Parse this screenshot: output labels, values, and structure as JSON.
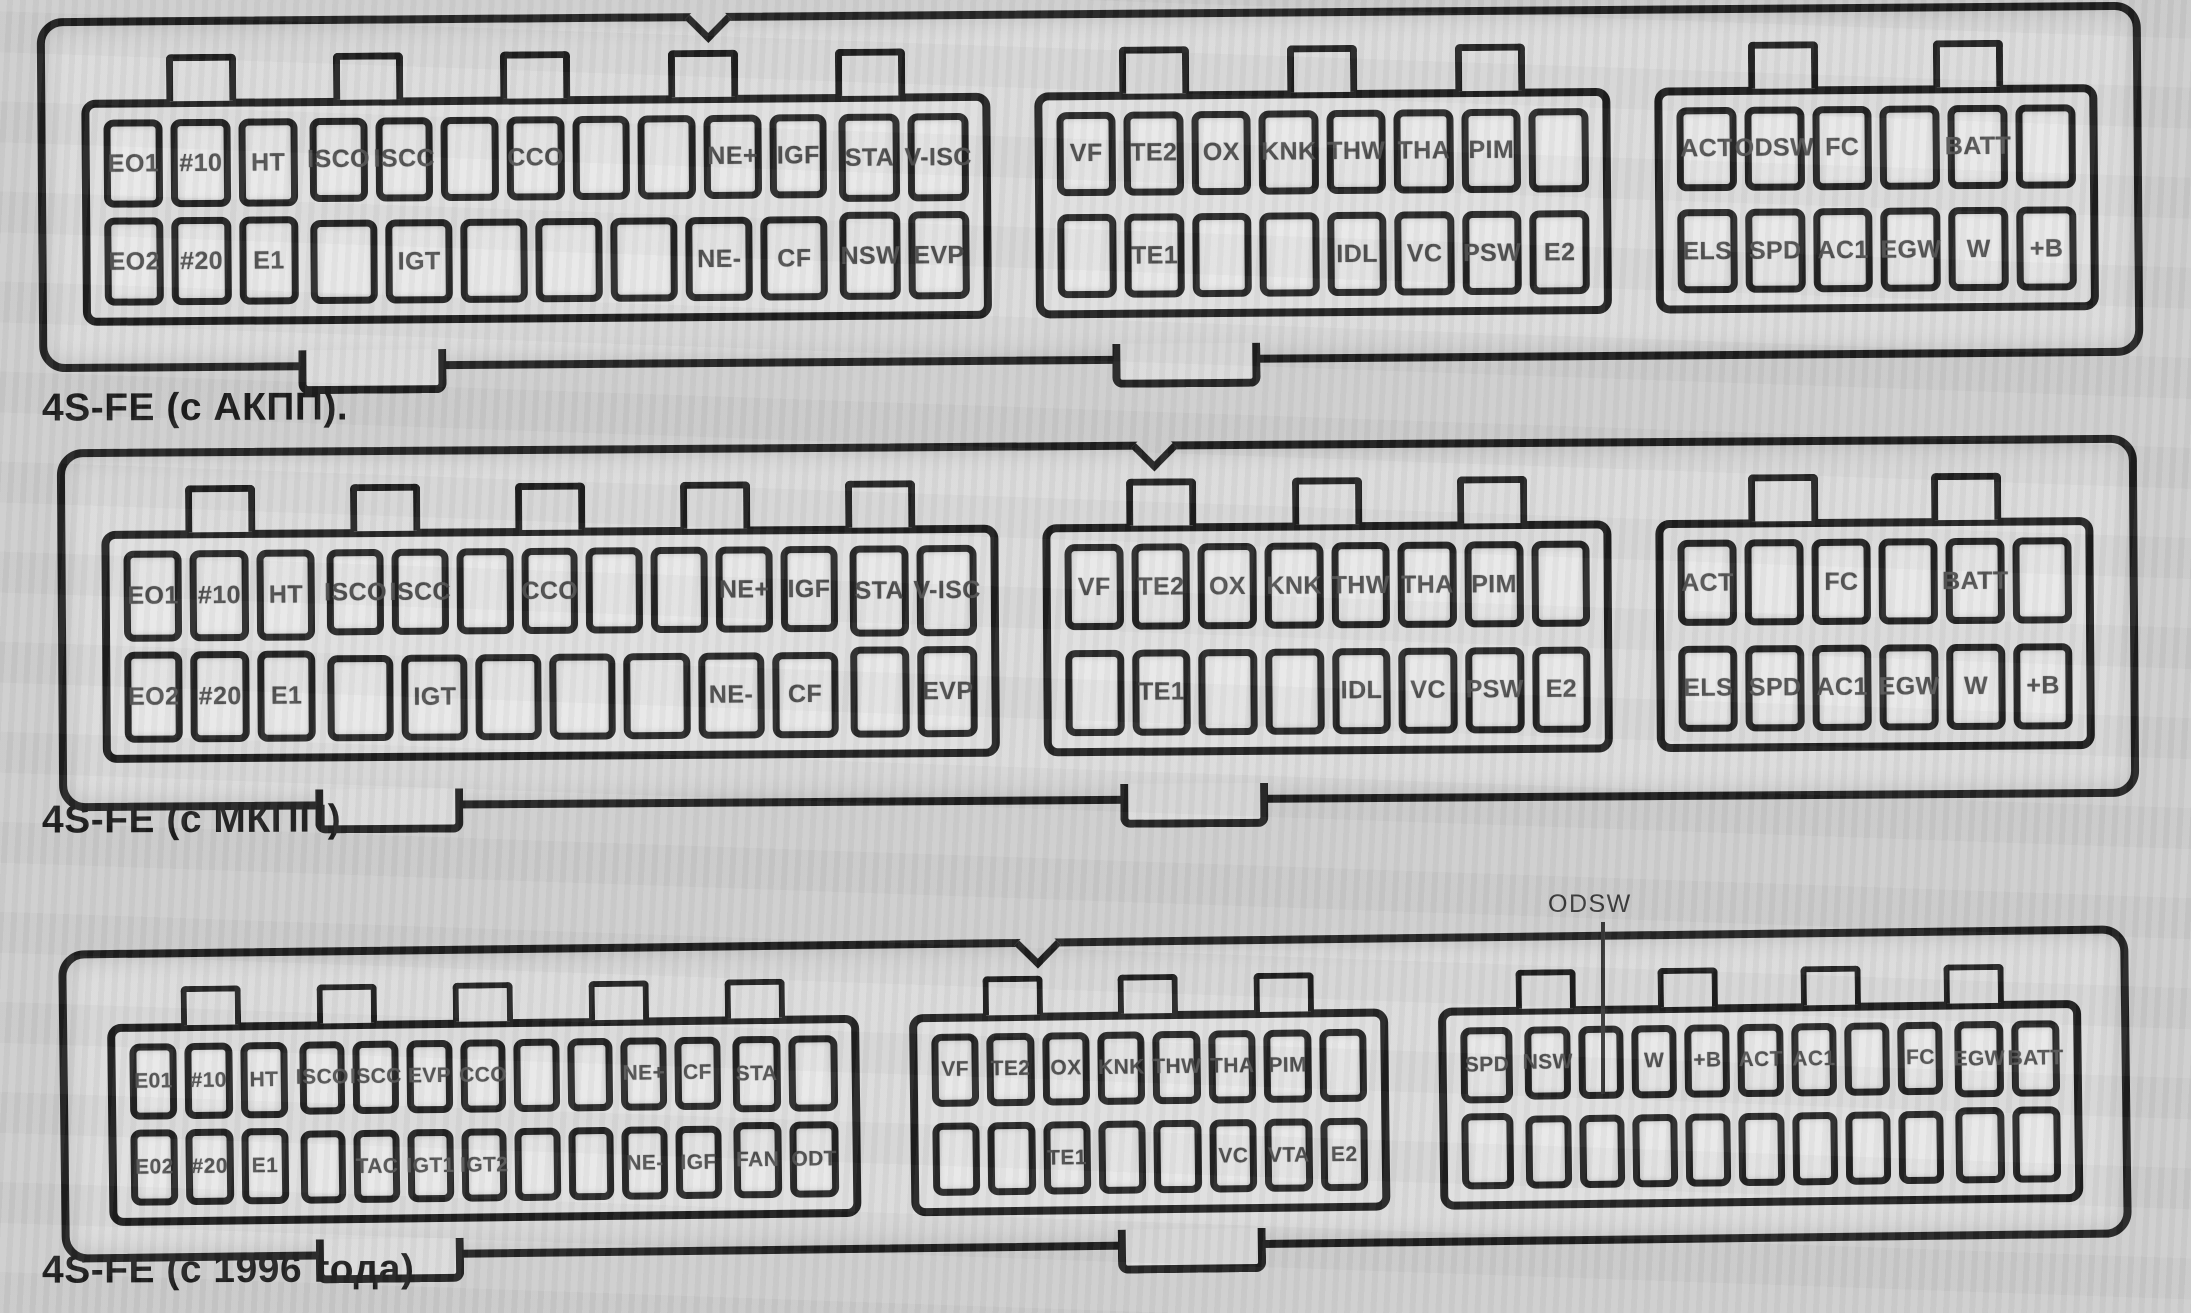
{
  "colors": {
    "ink": "#171717",
    "paper": "#cdcdcd",
    "housing": "#dadada",
    "cell": "#e8e8e8",
    "pin_label": "#4a4a4a"
  },
  "diagrams": [
    {
      "caption": "4S-FE (с АКПП).",
      "connectors": [
        {
          "name": "left",
          "sections": [
            {
              "type": "cols",
              "cols": [
                [
                  "EO1",
                  "EO2"
                ],
                [
                  "#10",
                  "#20"
                ],
                [
                  "HT",
                  "E1"
                ]
              ]
            },
            {
              "type": "rows",
              "top": [
                "ISCO",
                "ISCC",
                "",
                "CCO",
                "",
                "",
                "NE+",
                "IGF"
              ],
              "bottom": [
                "",
                "IGT",
                "",
                "",
                "",
                "NE-",
                "CF"
              ]
            },
            {
              "type": "cols",
              "cols": [
                [
                  "STA",
                  "NSW"
                ],
                [
                  "V-ISC",
                  "EVP"
                ]
              ]
            }
          ]
        },
        {
          "name": "middle",
          "sections": [
            {
              "type": "rows",
              "top": [
                "VF",
                "TE2",
                "OX",
                "KNK",
                "THW",
                "THA",
                "PIM",
                ""
              ],
              "bottom": [
                "",
                "TE1",
                "",
                "",
                "IDL",
                "VC",
                "PSW",
                "E2"
              ]
            }
          ]
        },
        {
          "name": "right",
          "sections": [
            {
              "type": "rows",
              "top": [
                "ACT",
                "ODSW",
                "FC",
                "",
                "BATT",
                ""
              ],
              "bottom": [
                "ELS",
                "SPD",
                "AC1",
                "EGW",
                "W",
                "+B"
              ]
            }
          ]
        }
      ]
    },
    {
      "caption": "4S-FE (с МКПП).",
      "connectors": [
        {
          "name": "left",
          "sections": [
            {
              "type": "cols",
              "cols": [
                [
                  "EO1",
                  "EO2"
                ],
                [
                  "#10",
                  "#20"
                ],
                [
                  "HT",
                  "E1"
                ]
              ]
            },
            {
              "type": "rows",
              "top": [
                "ISCO",
                "ISCC",
                "",
                "CCO",
                "",
                "",
                "NE+",
                "IGF"
              ],
              "bottom": [
                "",
                "IGT",
                "",
                "",
                "",
                "NE-",
                "CF"
              ]
            },
            {
              "type": "cols",
              "cols": [
                [
                  "STA",
                  ""
                ],
                [
                  "V-ISC",
                  "EVP"
                ]
              ]
            }
          ]
        },
        {
          "name": "middle",
          "sections": [
            {
              "type": "rows",
              "top": [
                "VF",
                "TE2",
                "OX",
                "KNK",
                "THW",
                "THA",
                "PIM",
                ""
              ],
              "bottom": [
                "",
                "TE1",
                "",
                "",
                "IDL",
                "VC",
                "PSW",
                "E2"
              ]
            }
          ]
        },
        {
          "name": "right",
          "sections": [
            {
              "type": "rows",
              "top": [
                "ACT",
                "",
                "FC",
                "",
                "BATT",
                ""
              ],
              "bottom": [
                "ELS",
                "SPD",
                "AC1",
                "EGW",
                "W",
                "+B"
              ]
            }
          ]
        }
      ]
    },
    {
      "caption": "4S-FE (с 1996 года).",
      "callout_label": "ODSW",
      "connectors": [
        {
          "name": "left",
          "sections": [
            {
              "type": "cols",
              "cols": [
                [
                  "E01",
                  "E02"
                ],
                [
                  "#10",
                  "#20"
                ],
                [
                  "HT",
                  "E1"
                ]
              ]
            },
            {
              "type": "rows",
              "top": [
                "ISCO",
                "ISCC",
                "EVP",
                "CCO",
                "",
                "",
                "NE+",
                "CF"
              ],
              "bottom": [
                "",
                "TAC",
                "IGT1",
                "IGT2",
                "",
                "",
                "NE-",
                "IGF"
              ]
            },
            {
              "type": "cols",
              "cols": [
                [
                  "STA",
                  "FAN"
                ],
                [
                  "",
                  "ODT"
                ]
              ]
            }
          ]
        },
        {
          "name": "middle",
          "sections": [
            {
              "type": "rows",
              "top": [
                "VF",
                "TE2",
                "OX",
                "KNK",
                "THW",
                "THA",
                "PIM",
                ""
              ],
              "bottom": [
                "",
                "",
                "TE1",
                "",
                "",
                "VC",
                "VTA",
                "E2"
              ]
            }
          ]
        },
        {
          "name": "right",
          "sections": [
            {
              "type": "cols",
              "cols": [
                [
                  "SPD",
                  ""
                ]
              ]
            },
            {
              "type": "rows",
              "top": [
                "NSW",
                "",
                "W",
                "+B",
                "ACT",
                "AC1",
                "",
                "FC"
              ],
              "bottom": [
                "",
                "",
                "",
                "",
                "",
                "",
                "",
                ""
              ]
            },
            {
              "type": "cols",
              "cols": [
                [
                  "EGW",
                  ""
                ],
                [
                  "BATT",
                  ""
                ]
              ]
            }
          ]
        }
      ]
    }
  ]
}
